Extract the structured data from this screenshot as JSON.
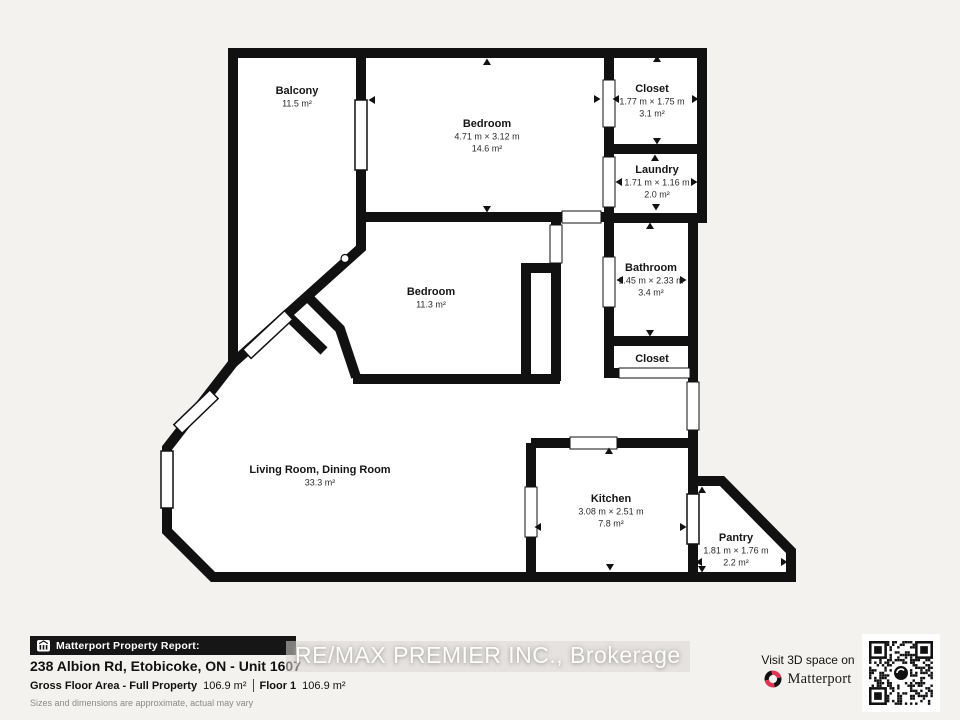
{
  "page": {
    "background": "#f4f2ef"
  },
  "plan": {
    "wall_color": "#111111",
    "room_fill": "#ffffff",
    "rooms": [
      {
        "id": "balcony",
        "name": "Balcony",
        "dims": "",
        "area": "11.5 m²",
        "x": 297,
        "y": 94
      },
      {
        "id": "bedroom-top",
        "name": "Bedroom",
        "dims": "4.71 m × 3.12 m",
        "area": "14.6 m²",
        "x": 487,
        "y": 127
      },
      {
        "id": "closet-top",
        "name": "Closet",
        "dims": "1.77 m × 1.75 m",
        "area": "3.1 m²",
        "x": 652,
        "y": 92
      },
      {
        "id": "laundry",
        "name": "Laundry",
        "dims": "1.71 m × 1.16 m",
        "area": "2.0 m²",
        "x": 657,
        "y": 173
      },
      {
        "id": "bathroom",
        "name": "Bathroom",
        "dims": "1.45 m × 2.33 m",
        "area": "3.4 m²",
        "x": 651,
        "y": 271
      },
      {
        "id": "closet-lower",
        "name": "Closet",
        "dims": "",
        "area": "",
        "x": 652,
        "y": 362
      },
      {
        "id": "bedroom-middle",
        "name": "Bedroom",
        "dims": "",
        "area": "11.3 m²",
        "x": 431,
        "y": 295
      },
      {
        "id": "living-dining",
        "name": "Living Room, Dining Room",
        "dims": "",
        "area": "33.3 m²",
        "x": 320,
        "y": 473
      },
      {
        "id": "kitchen",
        "name": "Kitchen",
        "dims": "3.08 m × 2.51 m",
        "area": "7.8 m²",
        "x": 611,
        "y": 502
      },
      {
        "id": "pantry",
        "name": "Pantry",
        "dims": "1.81 m × 1.76 m",
        "area": "2.2 m²",
        "x": 736,
        "y": 541
      }
    ]
  },
  "footer": {
    "report_label": "Matterport Property Report:",
    "address": "238 Albion Rd, Etobicoke, ON - Unit 1607",
    "gfa_label": "Gross Floor Area - Full Property",
    "gfa_value": "106.9 m²",
    "floor_label": "Floor 1",
    "floor_value": "106.9 m²",
    "disclaimer": "Sizes and dimensions are approximate, actual may vary",
    "watermark": "RE/MAX PREMIER INC., Brokerage"
  },
  "cta": {
    "visit_text": "Visit 3D space on",
    "brand": "Matterport",
    "brand_red": "#e23352"
  }
}
